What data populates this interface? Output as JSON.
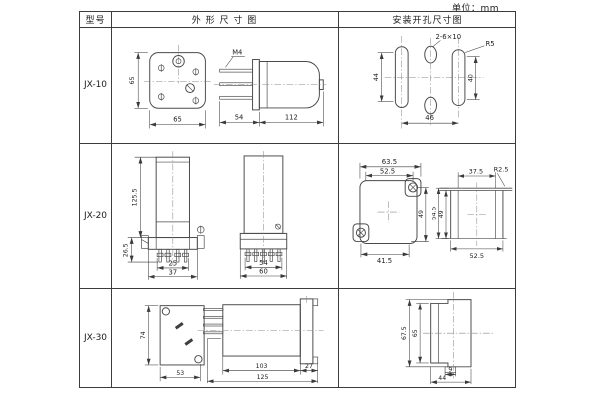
{
  "unit_label": "单位：mm",
  "headers": {
    "model": "型号",
    "outline": "外 形 尺 寸 图",
    "mounting": "安装开孔尺寸图"
  },
  "jx10": {
    "model": "JX-10",
    "front_h": "65",
    "front_w": "65",
    "thread": "M4",
    "pin_len": "54",
    "body_len": "112",
    "hole_label": "2-6×10",
    "slot_r": "R5",
    "left_h": "44",
    "right_h": "40",
    "span_w": "46"
  },
  "jx20": {
    "model": "JX-20",
    "total_h": "125.5",
    "pin_h": "26.5",
    "base_inner_w": "25",
    "base_w": "37",
    "side_inner_w": "54",
    "side_w": "60",
    "cut_outer_w": "63.5",
    "cut_inner_w": "52.5",
    "cut_h": "49",
    "cut_bottom_w": "41.5",
    "sec_inner_w": "37.5",
    "sec_r": "R2.5",
    "sec_outer_h": "54.5",
    "sec_inner_h": "49",
    "sec_w": "52.5"
  },
  "jx30": {
    "model": "JX-30",
    "back_h": "74",
    "back_w": "53",
    "body_len": "103",
    "flange_w": "27",
    "total_len": "125",
    "cut_outer_h": "67.5",
    "cut_inner_h": "65",
    "notch_w": "9",
    "cut_w": "44"
  }
}
